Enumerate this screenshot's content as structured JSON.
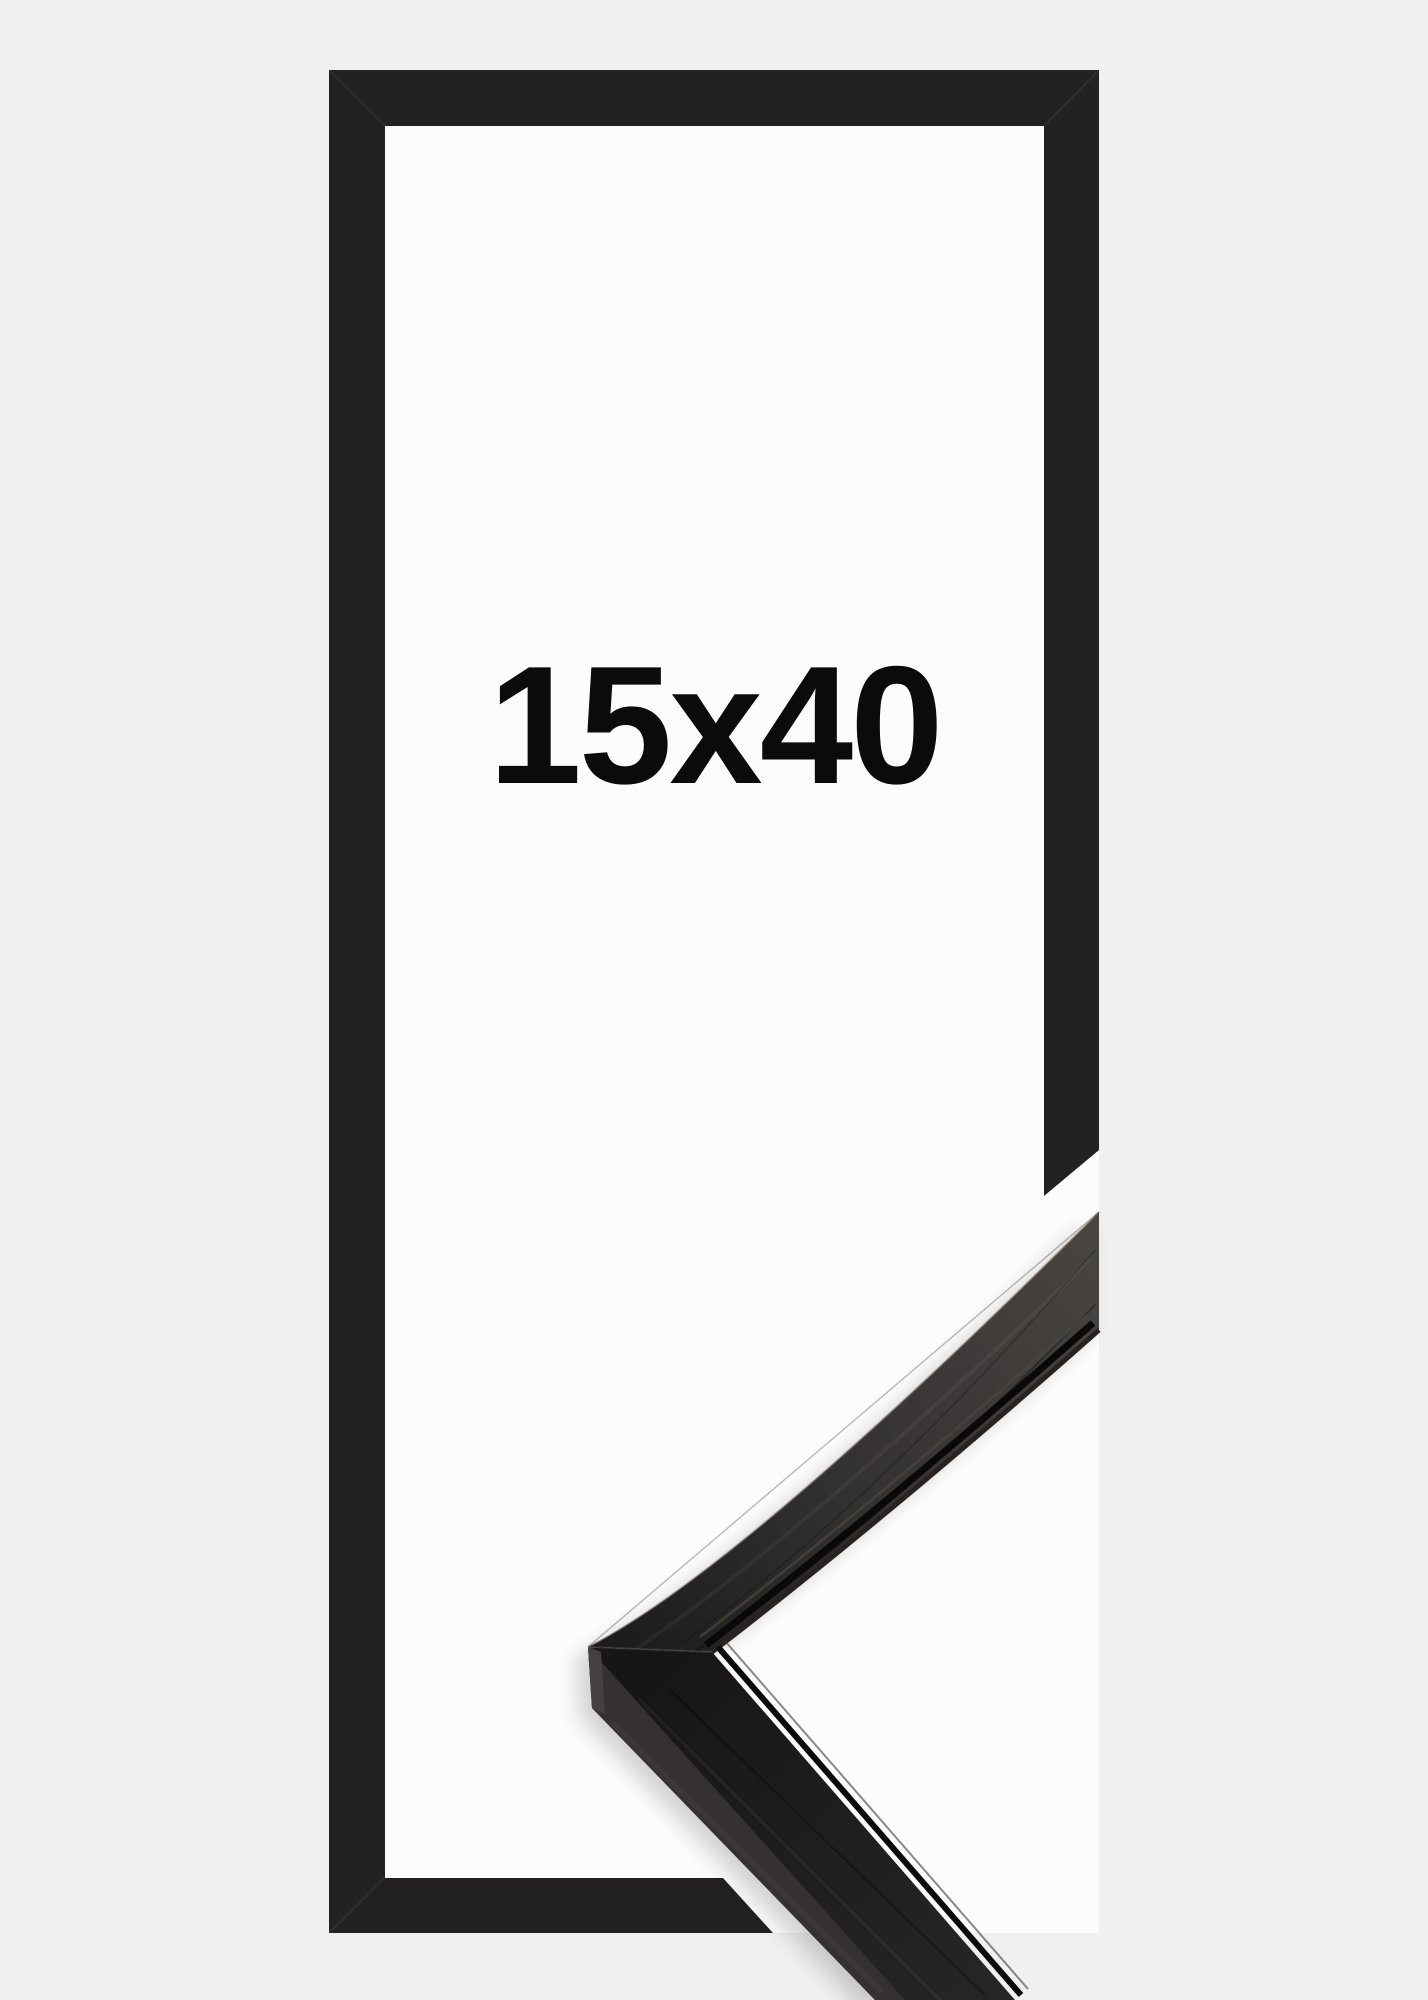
{
  "product": {
    "size_label": "15x40"
  },
  "colors": {
    "page_background": "#f1f0ef",
    "frame_outline": "#242221",
    "frame_opening": "#fcfcfc",
    "label_text": "#0b0b0b",
    "moulding_corner_dark": "#1c1a19",
    "moulding_face_light": "#474441",
    "moulding_side_face": "#343130",
    "moulding_end_face": "#454140",
    "moulding_groove": "#0a0909"
  }
}
